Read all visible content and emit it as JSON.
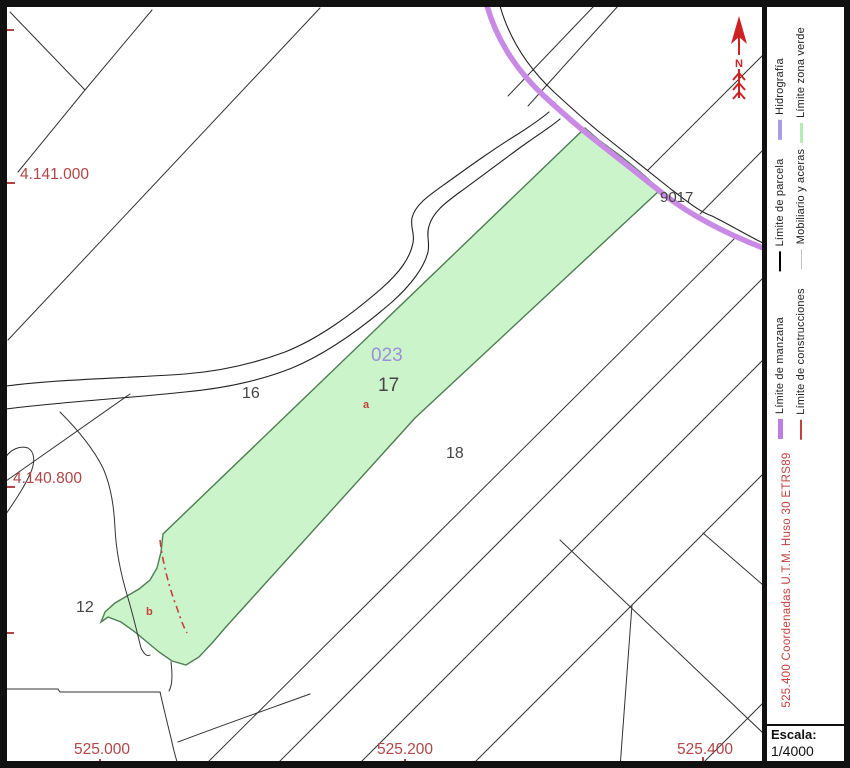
{
  "colors": {
    "coordinate_red": "#b04545",
    "construction_red": "#c4413d",
    "hydrography_purple": "#c98ae6",
    "green_fill": "#ccf4cb",
    "green_stroke": "#4e7d52",
    "parcel_label_purple": "#9a90d8",
    "parcel_label_gray": "#454545",
    "north_red": "#cc2222"
  },
  "map": {
    "green_zone_label": "023",
    "parcel_17": "17",
    "parcel_16": "16",
    "parcel_18": "18",
    "parcel_12": "12",
    "parcel_9017": "9017",
    "subparcel_a": "a",
    "subparcel_b": "b",
    "left_coordinates": [
      "4.141.000",
      "4.140.800"
    ],
    "bottom_coordinates": [
      "525.000",
      "525.200",
      "525.400"
    ]
  },
  "north_arrow": {
    "label": "N"
  },
  "legend": {
    "items": [
      {
        "label": "Hidrografía",
        "swatch_css": "background:#a89ce6;height:4px"
      },
      {
        "label": "Límite zona verde",
        "swatch_css": "background:#b5ecb5;height:3px"
      },
      {
        "label": "Límite de parcela",
        "swatch_css": "background:#000000;height:2px"
      },
      {
        "label": "Mobiliario y aceras",
        "swatch_css": "background:#c0c0c0;height:1px"
      },
      {
        "label": "Límite de manzana",
        "swatch_css": "background:#bd7ee0;height:5px"
      },
      {
        "label": "Límite de construcciones",
        "swatch_css": "background:#c4413d;height:2px"
      }
    ]
  },
  "crs_note": "525.400 Coordenadas U.T.M. Huso 30 ETRS89",
  "scale": {
    "label": "Escala:",
    "value": "1/4000"
  }
}
